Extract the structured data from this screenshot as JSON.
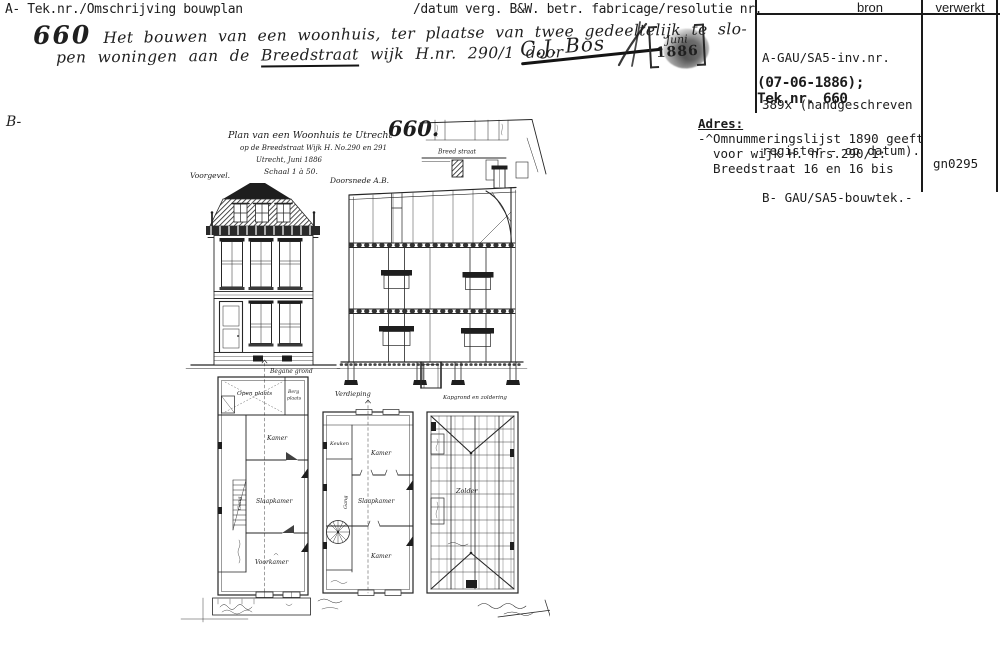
{
  "header": {
    "left": "A- Tek.nr./Omschrijving bouwplan",
    "right": "/datum verg. B&W. betr. fabricage/resolutie nr.",
    "b_label": "B-"
  },
  "handwritten": {
    "number": "660",
    "line1": "Het bouwen van een woonhuis, ter plaatse van twee gedeeltelijk te slo-",
    "line2a": "pen woningen aan de ",
    "street": "Breedstraat",
    "line2b": " wijk H.nr. 290/1 door",
    "signature": "C.J. Bos"
  },
  "stamp": {
    "month": "Juni",
    "year": "1886"
  },
  "source_panel": {
    "col_bron": "bron",
    "col_verwerkt": "verwerkt",
    "lines": [
      "A-GAU/SA5-inv.nr.",
      "389x (handgeschreven",
      "register - op datum).",
      "B- GAU/SA5-bouwtek.-"
    ],
    "date_line": "(07-06-1886);",
    "teknr_line": "Tek.nr. 660"
  },
  "adres": {
    "label": "Adres:",
    "line1": "-^Omnummeringslijst 1890 geeft",
    "line2": "voor wijk H. nrs.290/1:",
    "line3": "Breedstraat 16 en 16 bis",
    "code": "gn0295"
  },
  "drawing": {
    "number": "660.",
    "title1": "Plan van een Woonhuis te Utrecht",
    "title2": "op de Breedstraat Wijk H. No.290 en 291",
    "title3": "Utrecht, Juni 1886",
    "title4": "Schaal 1 à 50.",
    "labels": {
      "voorgevel": "Voorgevel.",
      "doorsnede": "Doorsnede A.B.",
      "straat": "Breed straat",
      "begane_grond": "Begane grond",
      "verdieping": "Verdieping",
      "kapgrond": "Kapgrond en zoldering",
      "zolder": "Zolder"
    },
    "rooms": {
      "open_plaats": "Open plaats",
      "berg_line1": "Berg",
      "berg_line2": "plaats",
      "kamer": "Kamer",
      "slaapkamer": "Slaapkamer",
      "voorkamer": "Voorkamer",
      "gang": "Gang",
      "keuken": "Keuken",
      "kamer2": "Kamer",
      "slaapkamer2": "Slaapkamer",
      "kamer3": "Kamer",
      "gang2": "Gang"
    }
  },
  "colors": {
    "ink": "#1c1c1c",
    "paper": "#ffffff"
  }
}
